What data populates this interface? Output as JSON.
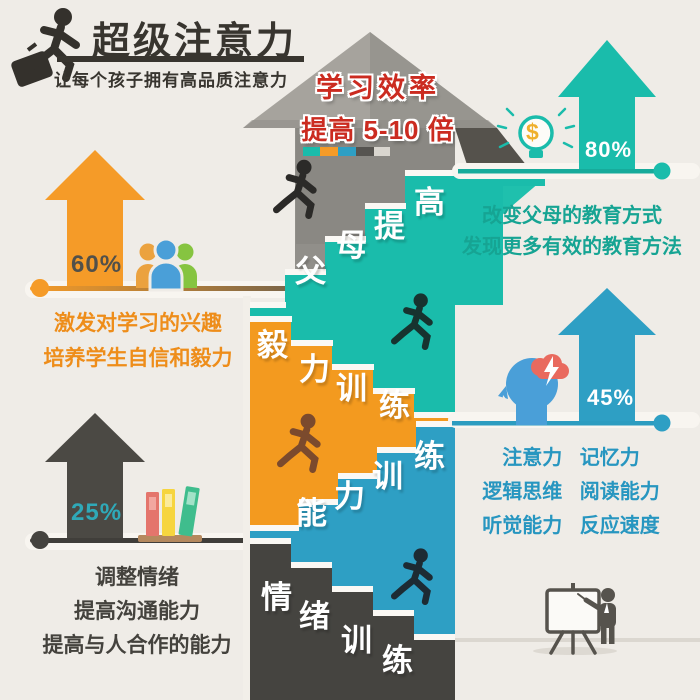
{
  "header": {
    "title": "超级注意力",
    "subtitle": "让每个孩子拥有高品质注意力",
    "logo": "running-businessman"
  },
  "center": {
    "headline_line1": "学习效率",
    "headline_line2": "提高 5-10 倍",
    "progress_segment_colors": [
      "#1abcab",
      "#f59b28",
      "#2e9fc4",
      "#565450",
      "#d9d6cf"
    ],
    "stairs": [
      {
        "label": "父母提高",
        "color": "#1abcab"
      },
      {
        "label": "毅力训练",
        "color": "#f39a1f"
      },
      {
        "label": "能力训练",
        "color": "#2e9fc4"
      },
      {
        "label": "情绪训练",
        "color": "#454440"
      }
    ]
  },
  "sections": {
    "left_top": {
      "percent": "60%",
      "icon": "group-people-icon",
      "lines": [
        "激发对学习的兴趣",
        "培养学生自信和毅力"
      ]
    },
    "left_bottom": {
      "percent": "25%",
      "icon": "books-icon",
      "lines": [
        "调整情绪",
        "提高沟通能力",
        "提高与人合作的能力"
      ]
    },
    "right_top": {
      "percent": "80%",
      "icon": "lightbulb-dollar-icon",
      "dollar_symbol": "$",
      "lines": [
        "改变父母的教育方式",
        "发现更多有效的教育方法"
      ]
    },
    "right_middle": {
      "percent": "45%",
      "icon": "head-brain-icon",
      "lines": [
        "注意力 记忆力",
        "逻辑思维 阅读能力",
        "听觉能力 反应速度"
      ]
    }
  },
  "colors": {
    "background": "#efece7",
    "teal": "#1abcab",
    "orange": "#f59b28",
    "blue": "#2e9fc4",
    "dark": "#454440",
    "red": "#cb2b20"
  }
}
